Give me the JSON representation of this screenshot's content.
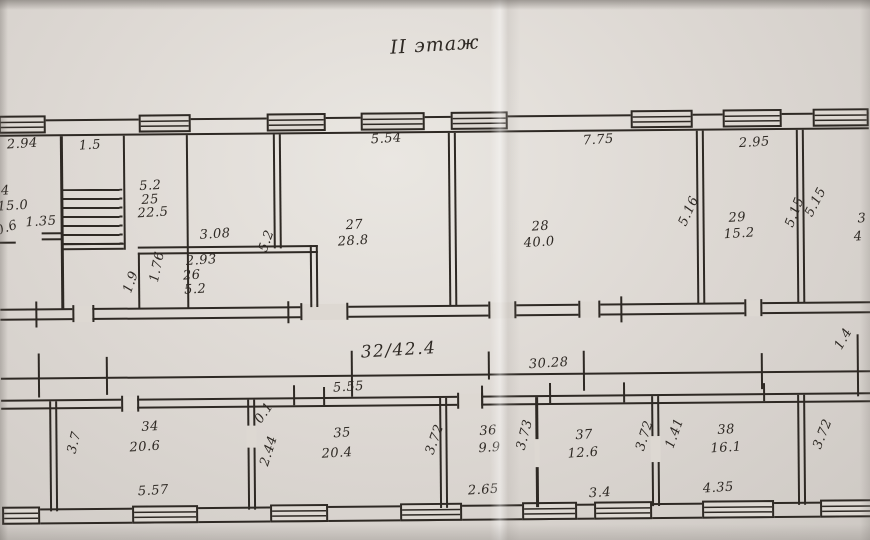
{
  "title": "II этаж",
  "colors": {
    "ink": "#2e2924",
    "paper": "#ddd8d2"
  },
  "upper_wing": {
    "rooms": {
      "r24": {
        "number": "24",
        "area": "15.0"
      },
      "r25": {
        "number": "25",
        "area": "22.5"
      },
      "r26": {
        "number": "26",
        "area": "5.2"
      },
      "r27": {
        "number": "27",
        "area": "28.8"
      },
      "r28": {
        "number": "28",
        "area": "40.0"
      },
      "r29": {
        "number": "29",
        "area": "15.2"
      },
      "r30_partial": {
        "number": "3",
        "area": "4"
      }
    },
    "dims": {
      "d294": "2.94",
      "d15": "1.5",
      "d06": "0.6",
      "d135": "1.35",
      "d52_25": "5.2",
      "d308": "3.08",
      "d293": "2.93",
      "d176": "1.76",
      "d19": "1.9",
      "d554": "5.54",
      "d52_27": "5.2",
      "d775": "7.75",
      "d516": "5.16",
      "d295": "2.95",
      "d515a": "5.15",
      "d515b": "5.15"
    }
  },
  "corridor": {
    "label": "32/42.4",
    "d3028": "30.28",
    "d14": "1.4"
  },
  "lower_wing": {
    "rooms": {
      "r34": {
        "number": "34",
        "area": "20.6"
      },
      "r35": {
        "number": "35",
        "area": "20.4"
      },
      "r36": {
        "number": "36",
        "area": "9.9"
      },
      "r37": {
        "number": "37",
        "area": "12.6"
      },
      "r38": {
        "number": "38",
        "area": "16.1"
      }
    },
    "dims": {
      "d37": "3.7",
      "d557": "5.57",
      "d01": "0.1",
      "d244": "2.44",
      "d555": "5.55",
      "d372a": "3.72",
      "d265": "2.65",
      "d373": "3.73",
      "d34": "3.4",
      "d372b": "3.72",
      "d141": "1.41",
      "d435": "4.35",
      "d372c": "3.72"
    }
  }
}
